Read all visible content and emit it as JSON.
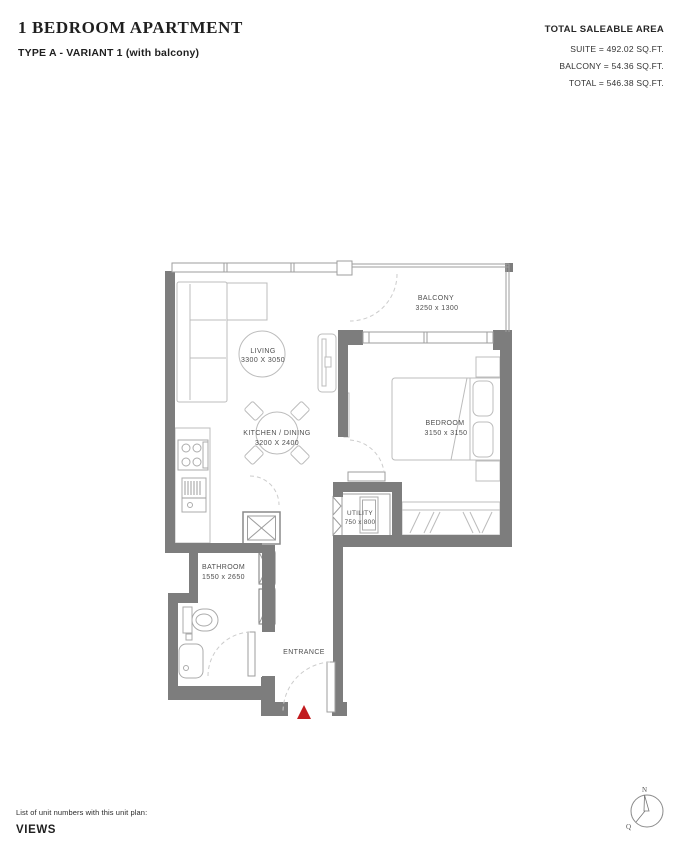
{
  "header": {
    "title": "1 BEDROOM APARTMENT",
    "subtitle": "TYPE A - VARIANT 1 (with balcony)",
    "area_summary": {
      "title": "TOTAL SALEABLE AREA",
      "suite": "SUITE = 492.02 SQ.FT.",
      "balcony": "BALCONY = 54.36 SQ.FT.",
      "total": "TOTAL = 546.38 SQ.FT."
    }
  },
  "floor_plan": {
    "wall_color": "#7d7d7d",
    "entrance_marker_color": "#c21b1f",
    "rooms": [
      {
        "name": "LIVING",
        "dimensions": "3300 X 3050"
      },
      {
        "name": "KITCHEN / DINING",
        "dimensions": "3200 X 2400"
      },
      {
        "name": "BALCONY",
        "dimensions": "3250 x 1300"
      },
      {
        "name": "BEDROOM",
        "dimensions": "3150 x 3150"
      },
      {
        "name": "UTILITY",
        "dimensions": "750 x 800"
      },
      {
        "name": "BATHROOM",
        "dimensions": "1550 x 2650"
      }
    ],
    "entrance_label": "ENTRANCE"
  },
  "compass": {
    "north_label": "N",
    "q_label": "Q"
  },
  "footer": {
    "note": "List of unit numbers with this unit plan:",
    "views_label": "VIEWS"
  }
}
